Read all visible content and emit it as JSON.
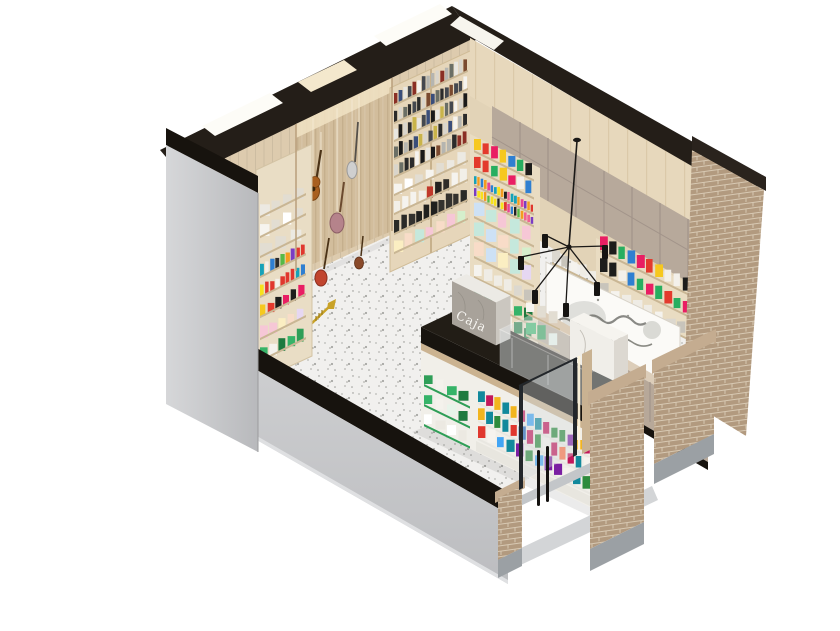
{
  "scene": {
    "description": "Isometric cutaway 3D render of a small music, book and stationery shop",
    "background": "#ffffff",
    "labels": {
      "register_sign": "Caja"
    },
    "colors": {
      "ceiling": "#241e18",
      "wood_wall": "#ddcbae",
      "slat_wall": "#d2bd9c",
      "wood_top": "#e7d8bc",
      "cabinet": "#b7a99b",
      "counter_face": "#b7a899",
      "counter_top": "#dccdb9",
      "gray_wall": "#c6c7c9",
      "black_trim": "#17130e",
      "floor_base": "#f1f0ee",
      "brick": "#b29a7f",
      "mortar": "#d8c9b3",
      "marble_light": "#f0eee9",
      "marble_shade": "#a8a29a",
      "island_black": "#18140f",
      "accent_green": "#2f9e57",
      "glass": "#d7dee0",
      "led": "#fff6dd",
      "mural_paper": "#fbfaf7"
    },
    "palettes": {
      "books": [
        "#2b2b2b",
        "#f5f3ef",
        "#b5b5b0",
        "#8a2f25",
        "#3a4e7a",
        "#d9d5cc",
        "#1a1a1a",
        "#6b6f66",
        "#c9b44a",
        "#7a4a2f",
        "#e8e6e0",
        "#44484f"
      ],
      "white_boxes": [
        "#f6f4ef",
        "#ece9e2",
        "#ffffff",
        "#e2ddd2"
      ],
      "binders": [
        "#f2efe8",
        "#23211e",
        "#c0392b",
        "#f5f3ee",
        "#2f2c28"
      ],
      "dark_rolls": [
        "#20201e",
        "#34322e",
        "#151513",
        "#2a2a27"
      ],
      "pastel": [
        "#f6c7d6",
        "#c5e8dc",
        "#cde1f5",
        "#e6d7f2",
        "#fbeec2",
        "#d5efcc",
        "#f8dcc8"
      ],
      "pens": [
        "#e0372e",
        "#f39c1f",
        "#f7e11c",
        "#57b947",
        "#2f7fd1",
        "#7a3cc3",
        "#e84393",
        "#17a2b8",
        "#222222",
        "#f06292"
      ],
      "candy": [
        "#e0372e",
        "#2e8b3d",
        "#1f63b8",
        "#f2b51f",
        "#c2185b",
        "#12899c",
        "#f6f3ee",
        "#7b1fa2",
        "#ff7043",
        "#42a5f5"
      ],
      "bright_boxes": [
        "#e33a2d",
        "#f6c81f",
        "#2f7fd1",
        "#f3f0ea",
        "#27ae60",
        "#1d1d1b",
        "#e91e63"
      ],
      "green_products": [
        "#2f9e57",
        "#f4f2ec",
        "#1e7a3f",
        "#e8f4ea",
        "#36b368"
      ],
      "cards": [
        "#dcd8cf",
        "#efece5",
        "#c8c4bb",
        "#f5f3ee"
      ],
      "paints": [
        "#e0372e",
        "#f39c1f",
        "#2f7fd1",
        "#57b947",
        "#f7e11c",
        "#7a3cc3",
        "#17a2b8",
        "#e84393",
        "#2b2b2b",
        "#f4f1ea"
      ]
    },
    "objects": [
      "acoustic-guitar",
      "electric-guitar",
      "cello",
      "violin",
      "trumpet",
      "bookshelf",
      "instrument-slat-wall",
      "skylights",
      "chandelier",
      "wave-mural",
      "cash-counter",
      "island-display-counter",
      "glass-entrance-door",
      "brick-pillars",
      "terrazzo-floor"
    ]
  }
}
